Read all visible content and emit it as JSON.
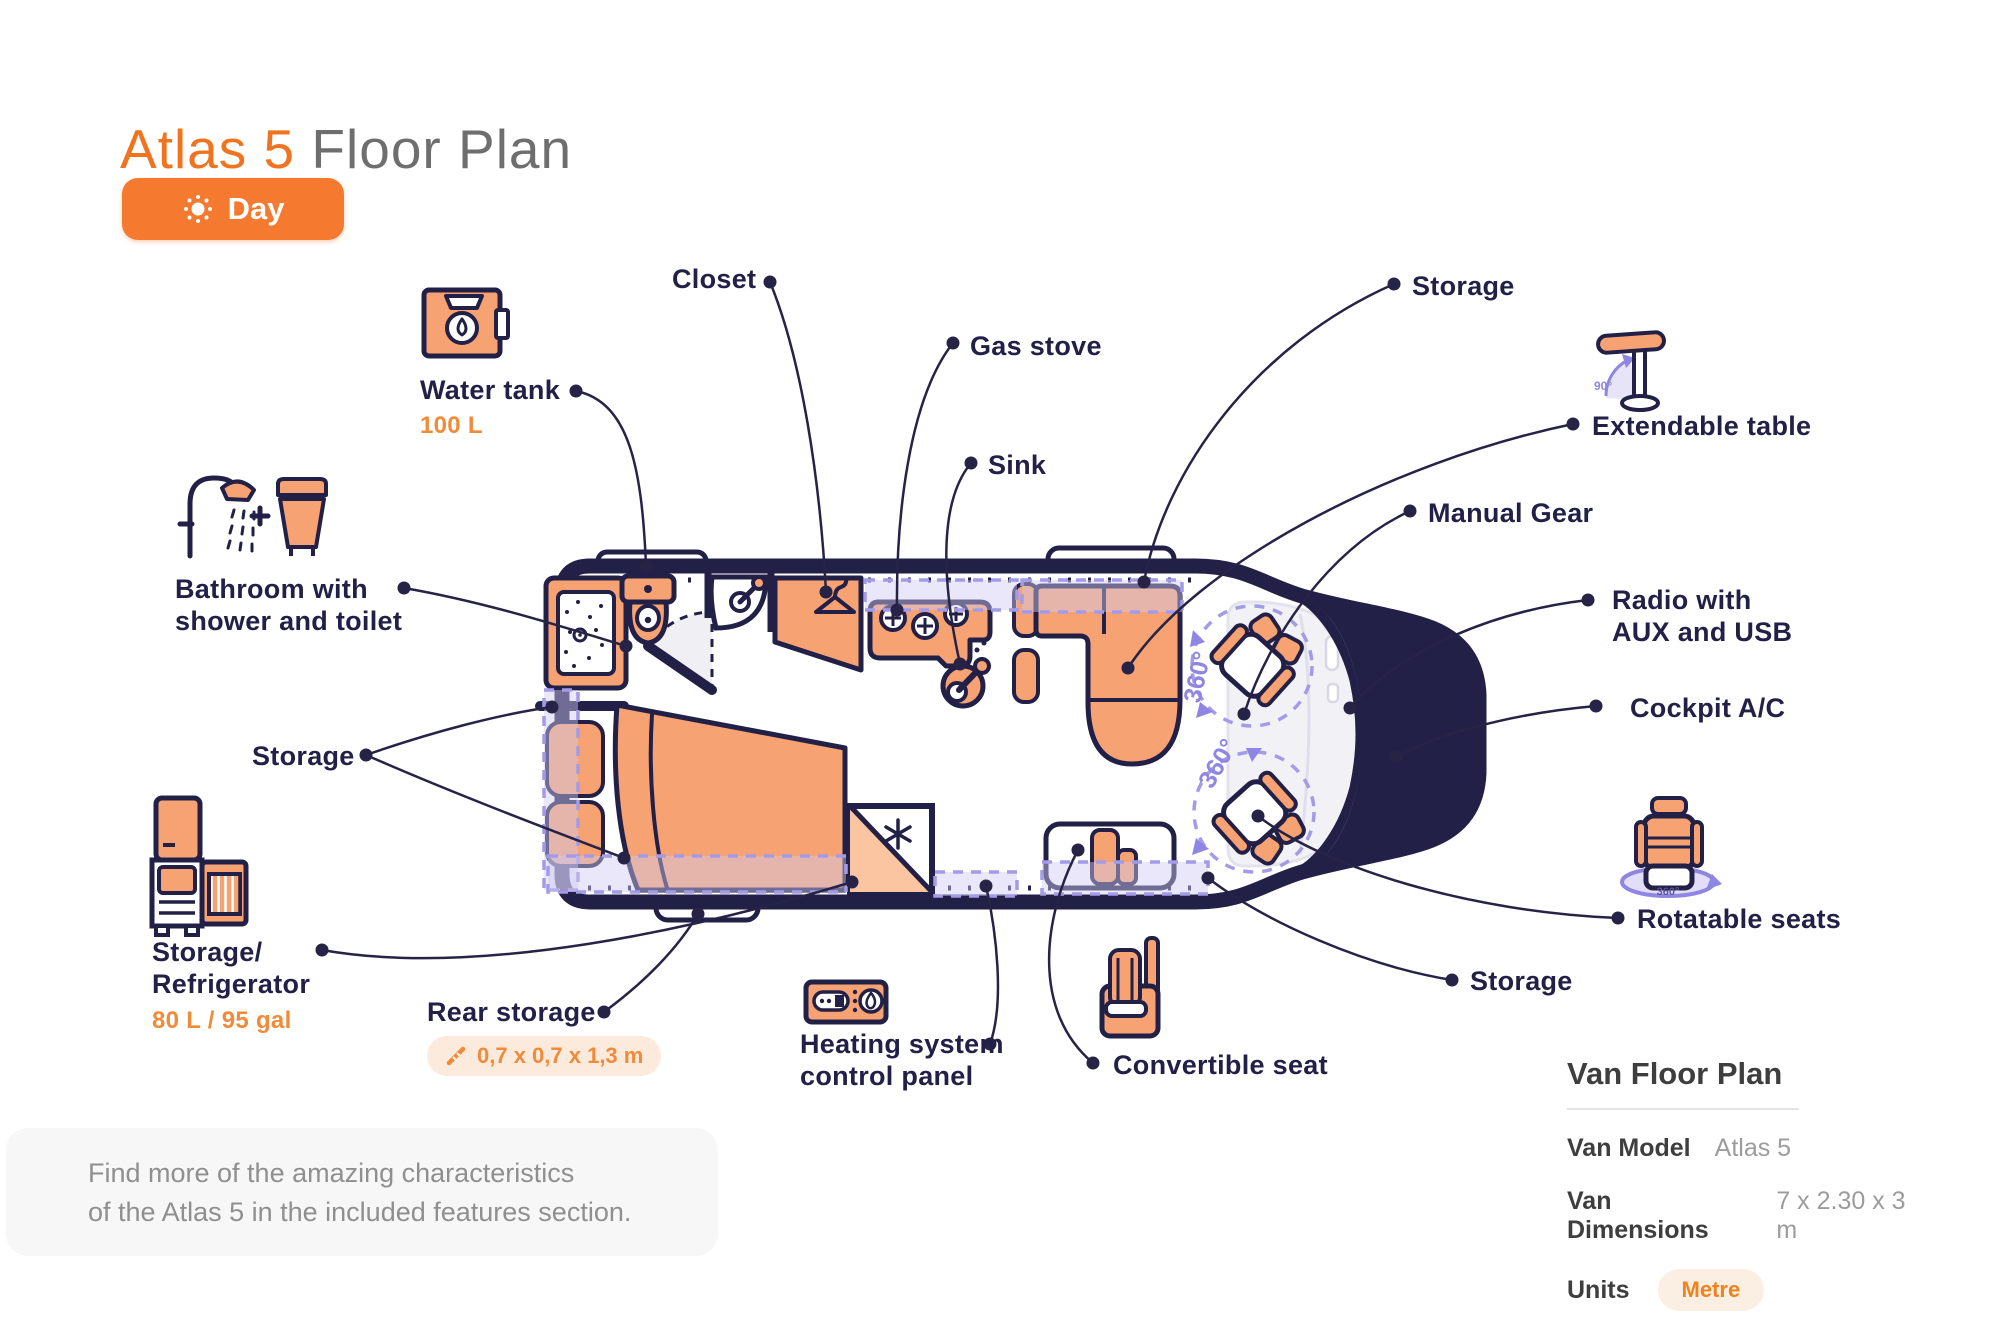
{
  "header": {
    "title_accent": "Atlas 5",
    "title_rest": " Floor Plan",
    "mode_button_label": "Day"
  },
  "callouts": {
    "water_tank": {
      "label": "Water tank",
      "value": "100 L"
    },
    "bathroom": {
      "line1": "Bathroom with",
      "line2": "shower and toilet"
    },
    "storage_left": {
      "label": "Storage"
    },
    "storage_refrigerator": {
      "line1": "Storage/",
      "line2": "Refrigerator",
      "value": "80 L / 95 gal"
    },
    "rear_storage": {
      "label": "Rear storage",
      "dimensions": "0,7 x 0,7 x 1,3 m"
    },
    "closet": {
      "label": "Closet"
    },
    "gas_stove": {
      "label": "Gas stove"
    },
    "sink": {
      "label": "Sink"
    },
    "storage_top": {
      "label": "Storage"
    },
    "extendable_table": {
      "label": "Extendable table",
      "angle_note": "90°"
    },
    "manual_gear": {
      "label": "Manual Gear"
    },
    "radio": {
      "line1": "Radio with",
      "line2": "AUX and USB"
    },
    "cockpit_ac": {
      "label": "Cockpit A/C"
    },
    "rotatable_seats": {
      "label": "Rotatable seats",
      "icon_note": "360°"
    },
    "storage_right": {
      "label": "Storage"
    },
    "convertible_seat": {
      "label": "Convertible seat"
    },
    "heating_panel": {
      "line1": "Heating system",
      "line2": "control panel"
    }
  },
  "floor_plan": {
    "seat_rotation_front": "360°",
    "seat_rotation_rear": "360°"
  },
  "note": {
    "line1": "Find more of the amazing characteristics",
    "line2": "of the Atlas 5 in the included features section."
  },
  "info_panel": {
    "title": "Van Floor Plan",
    "rows": [
      {
        "label": "Van Model",
        "value": "Atlas 5"
      },
      {
        "label": "Van Dimensions",
        "value": "7 x 2.30 x 3 m"
      }
    ],
    "units_label": "Units",
    "units_value": "Metre"
  },
  "colors": {
    "accent_orange": "#F0741F",
    "furniture_orange": "#F7A272",
    "navy": "#232047",
    "lavender": "#A49BE8"
  }
}
